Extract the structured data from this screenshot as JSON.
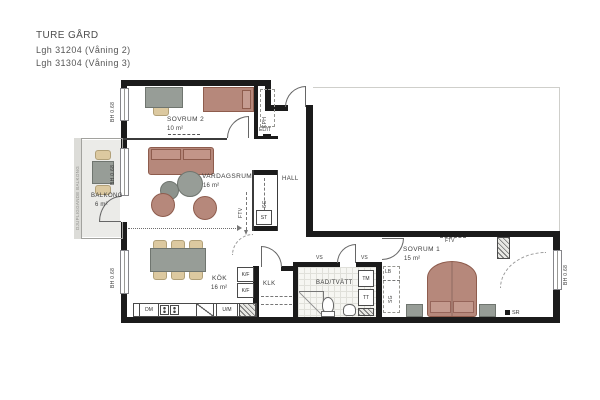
{
  "title": {
    "project": "TURE GÅRD",
    "apartment_line1": "Lgh 31204  (Våning 2)",
    "apartment_line2": "Lgh 31304  (Våning 3)"
  },
  "rooms": {
    "sovrum2": {
      "name": "SOVRUM 2",
      "area": "10 m²"
    },
    "vardagsrum": {
      "name": "VARDAGSRUM",
      "area": "16 m²"
    },
    "balkong": {
      "name": "BALKONG",
      "area": "6 m²"
    },
    "kok": {
      "name": "KÖK",
      "area": "16 m²"
    },
    "hall": {
      "name": "HALL"
    },
    "klk": {
      "name": "KLK"
    },
    "badtvatt": {
      "name": "BAD/TVÄTT"
    },
    "sovrum1": {
      "name": "SOVRUM 1",
      "area": "15 m²"
    }
  },
  "annotations": {
    "kph": "KPH",
    "elit": "EL/IT",
    "sg_hall_closet": "SG",
    "st": "ST",
    "ftv_hall": "FTV",
    "ftv_sovrum1": "FTV",
    "vs_left": "VS",
    "vs_right": "VS",
    "tm": "TM",
    "tt": "TT",
    "lb": "LB",
    "sg_sovrum1": "SG",
    "dm": "DM",
    "um": "U/M",
    "kf_upper": "K/F",
    "kf_lower": "K/F",
    "sr": "SR",
    "bh": "BH 0.68",
    "balcony_note": "DJUPLIGGANDE BALKONG"
  },
  "colors": {
    "wall": "#1b1b1b",
    "furniture_red": "#b6887b",
    "furniture_red_border": "#8e5c4d",
    "furniture_gray": "#979d97",
    "furniture_gray_border": "#6f756f",
    "wood_beige": "#dcc9a0",
    "wood_beige_border": "#b1a078",
    "balcony_floor": "#ebebe8",
    "tile_line": "#e0e0da"
  }
}
